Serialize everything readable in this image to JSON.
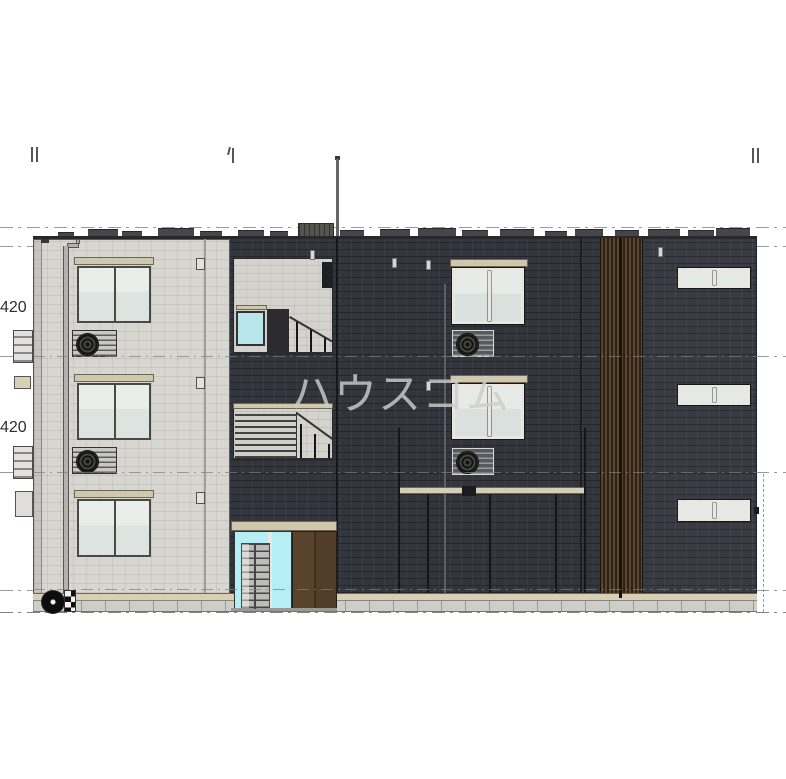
{
  "watermark": {
    "text": "ハウスコム",
    "color": "#cdcdcd"
  },
  "dimensions": {
    "upper": "420",
    "lower": "420"
  },
  "drawing": {
    "type": "architectural-elevation",
    "subject": "three-story-apartment-building-front-elevation",
    "stories": 3,
    "sections": [
      {
        "name": "left-wing",
        "finish": "light-gray-siding"
      },
      {
        "name": "center-wing-with-stairwell-and-entrance",
        "finish": "dark-navy-siding"
      },
      {
        "name": "wood-louver-screen",
        "finish": "vertical-brown-louvers"
      },
      {
        "name": "right-wing",
        "finish": "dark-navy-siding-with-slot-windows"
      }
    ],
    "features": [
      "lightning-rod-on-roof",
      "rooftop-equipment",
      "stairwell-openings",
      "entrance-with-mailboxes",
      "brown-double-entrance-door",
      "wall-ac-louver-boxes",
      "outdoor-fan-unit-at-grade",
      "downspout",
      "datum-dash-dot-lines",
      "grid-reference-ticks"
    ]
  },
  "colors": {
    "wall_light": "#d7d6d1",
    "wall_dark": "#33353c",
    "wall_dark_right": "#393b43",
    "louver_brown": "#56422c",
    "entrance_glass_cyan": "#b5eef4",
    "stair_window_cyan": "#b9e6ec",
    "door_brown": "#553f29",
    "header_beige": "#d0c8ac",
    "base_band_beige": "#d8cfb4",
    "foundation_gray": "#cdcdc9",
    "datum_line_gray": "#9a9a9a"
  }
}
